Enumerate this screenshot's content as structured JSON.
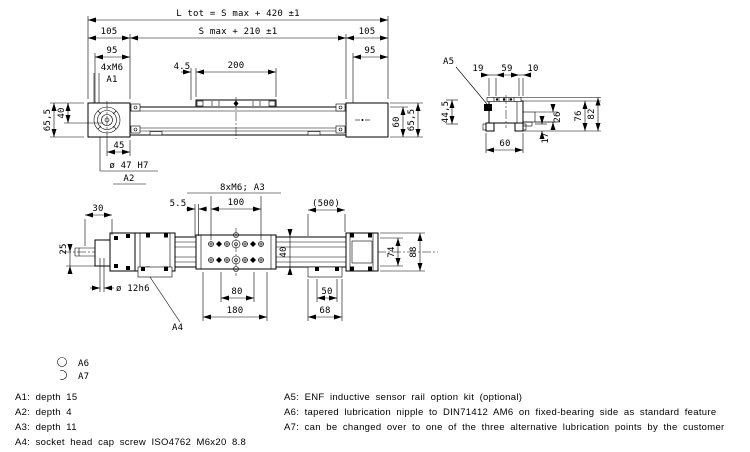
{
  "colors": {
    "line": "#000000",
    "background": "#ffffff"
  },
  "top_view": {
    "l_tot": "L tot = S max + 420 ±1",
    "d105_l": "105",
    "s_max": "S max + 210 ±1",
    "d105_r": "105",
    "d95_l": "95",
    "d95_r": "95",
    "holes": "4xM6",
    "ref_a1": "A1",
    "d45_offset": "4.5",
    "d200": "200",
    "d655_l": "65,5",
    "d40": "40",
    "d45": "45",
    "bore": "ø 47 H7",
    "ref_a2": "A2",
    "d60": "60",
    "d655_r": "65,5"
  },
  "end_view": {
    "ref_a5": "A5",
    "d19": "19",
    "d59": "59",
    "d10": "10",
    "d445": "44,5",
    "d26": "26",
    "d17": "17",
    "d76": "76",
    "d82": "82",
    "d60": "60"
  },
  "plan_view": {
    "holes": "8xM6; A3",
    "d30": "30",
    "d55": "5.5",
    "d100": "100",
    "d500": "(500)",
    "d25": "25",
    "shaft": "ø 12h6",
    "ref_a4": "A4",
    "d80": "80",
    "d180": "180",
    "d40": "40",
    "d74": "74",
    "d88": "88",
    "d50": "50",
    "d68": "68"
  },
  "legend": {
    "a6": "A6",
    "a7": "A7",
    "notes_left": [
      "A1: depth 15",
      "A2: depth 4",
      "A3: depth 11",
      "A4: socket head cap screw ISO4762 M6x20 8.8"
    ],
    "notes_right": [
      "A5: ENF inductive sensor rail option kit (optional)",
      "A6: tapered lubrication nipple to DIN71412 AM6 on fixed-bearing side as standard feature",
      "A7: can be changed over to one of the three alternative lubrication points by the customer"
    ]
  }
}
